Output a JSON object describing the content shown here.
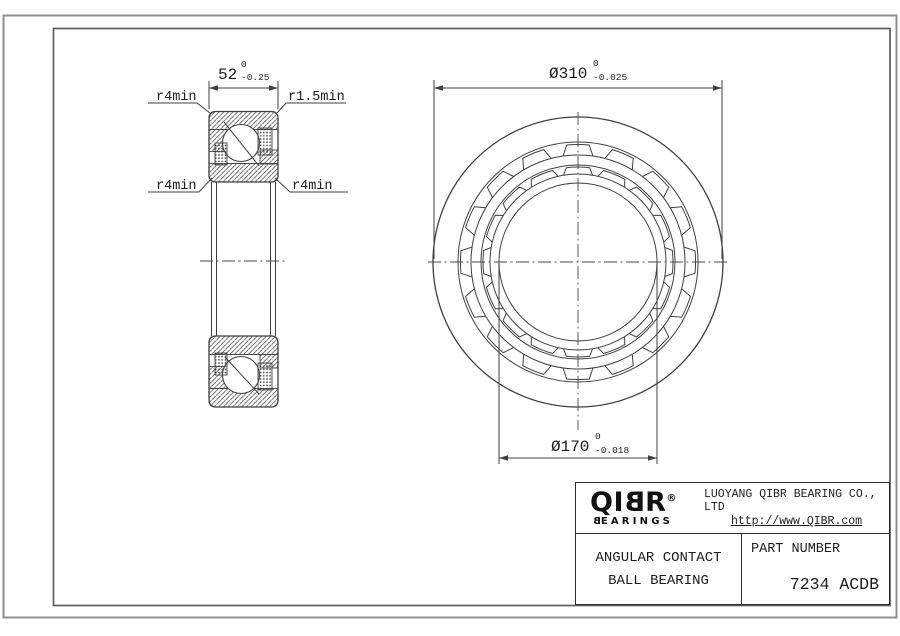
{
  "section_view": {
    "width_dim": {
      "value": "52",
      "tol_upper": "0",
      "tol_lower": "-0.25"
    },
    "r_top_left": "r4min",
    "r_top_right": "r1.5min",
    "r_bottom_left": "r4min",
    "r_bottom_right": "r4min"
  },
  "front_view": {
    "od_dim": {
      "value": "Ø310",
      "tol_upper": "0",
      "tol_lower": "-0.025"
    },
    "bore_dim": {
      "value": "Ø170",
      "tol_upper": "0",
      "tol_lower": "-0.018"
    },
    "pocket_count": 16
  },
  "title_block": {
    "logo_text": "QIBR",
    "logo_registered": "®",
    "logo_subtext": "BEARINGS",
    "company_name": "LUOYANG QIBR BEARING CO., LTD",
    "website": "http://www.QIBR.com",
    "product_line1": "ANGULAR CONTACT",
    "product_line2": "BALL BEARING",
    "part_number_label": "PART NUMBER",
    "part_number": "7234 ACDB"
  }
}
